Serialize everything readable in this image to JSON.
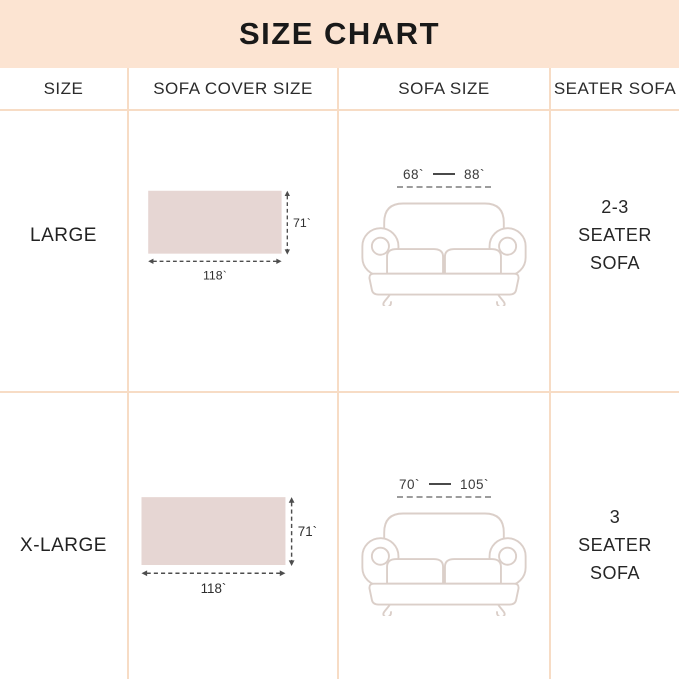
{
  "title": "SIZE CHART",
  "header": {
    "col1": "SIZE",
    "col2": "SOFA COVER SIZE",
    "col3": "SOFA SIZE",
    "col4": "SEATER SOFA"
  },
  "rows": [
    {
      "size": "LARGE",
      "cover": {
        "width_label": "118`",
        "height_label": "71`"
      },
      "sofa": {
        "min_label": "68`",
        "max_label": "88`"
      },
      "seater": {
        "line1": "2-3",
        "line2": "SEATER SOFA"
      }
    },
    {
      "size": "X-LARGE",
      "cover": {
        "width_label": "118`",
        "height_label": "71`"
      },
      "sofa": {
        "min_label": "70`",
        "max_label": "105`"
      },
      "seater": {
        "line1": "3",
        "line2": "SEATER SOFA"
      }
    }
  ],
  "colors": {
    "band": "#fce4d2",
    "grid": "#f7dcc5",
    "swatch": "#e6d6d3",
    "sofa-line": "#dbcfc9",
    "dim": "#4d4d4d",
    "text": "#222222"
  }
}
